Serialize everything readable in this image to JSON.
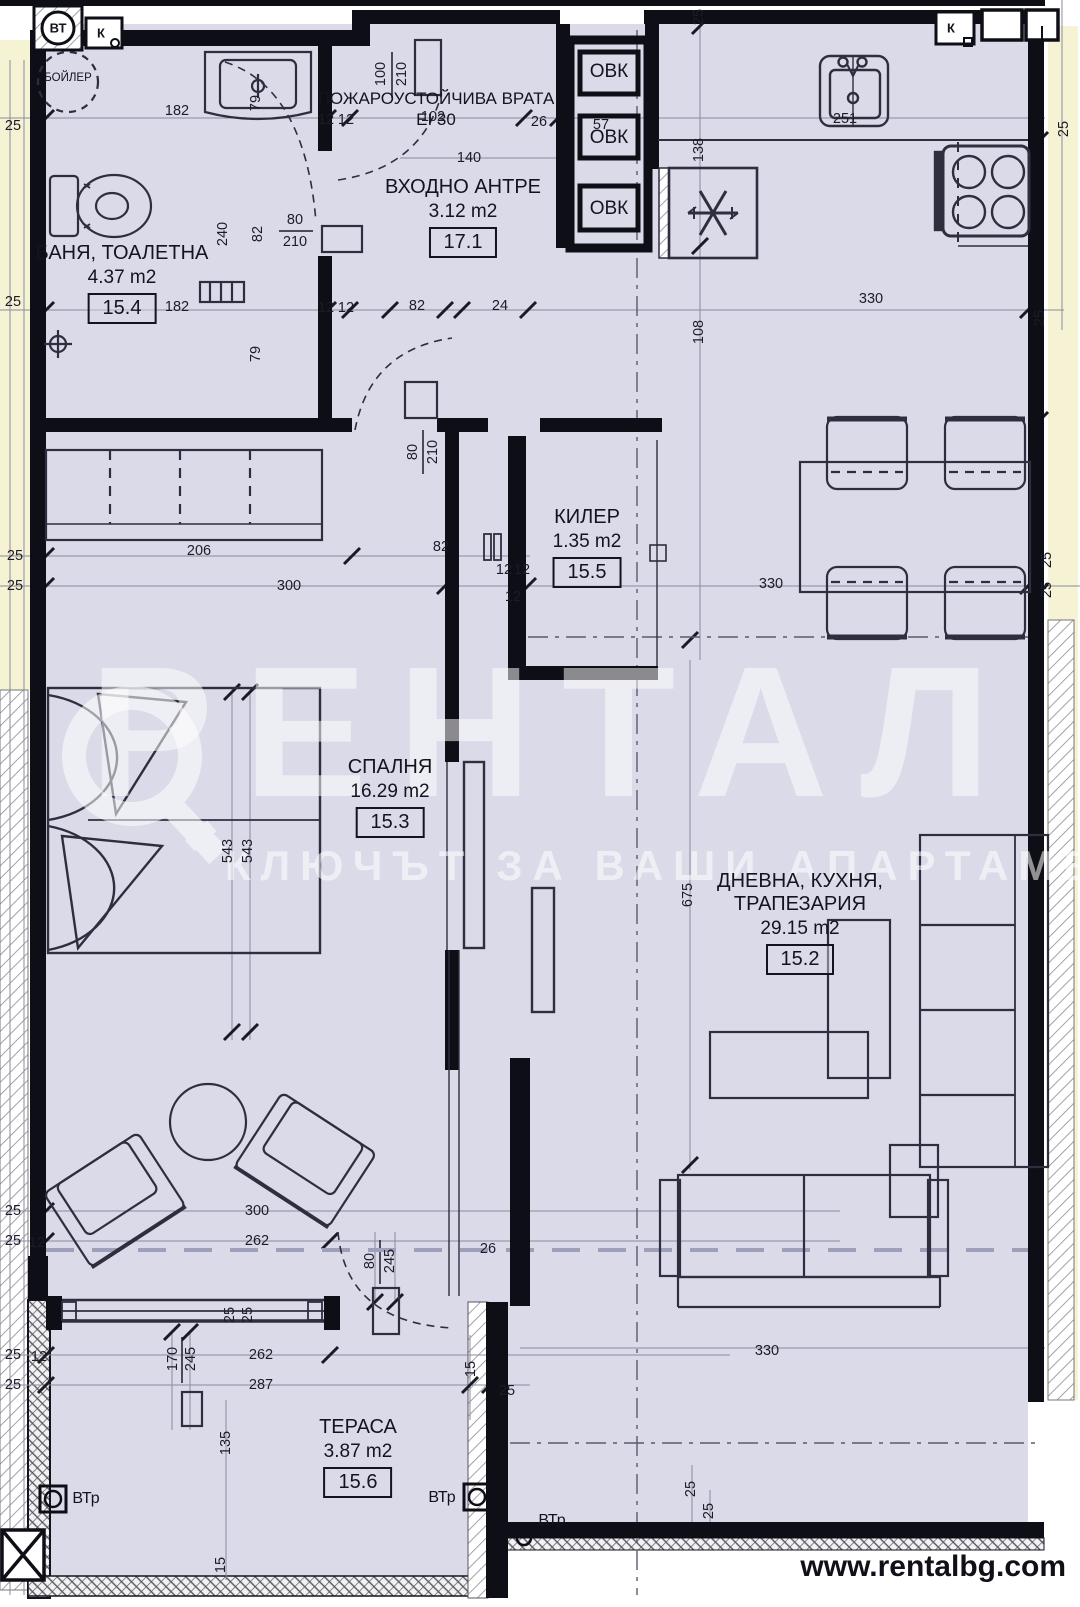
{
  "footer": {
    "website": "www.rentalbg.com"
  },
  "watermark": {
    "brand": "РЕНТАЛ",
    "slogan": "КЛЮЧЪТ ЗА ВАШИ АПАРТАМЕНТИ"
  },
  "rooms": [
    {
      "name": "БАНЯ, ТОАЛЕТНА",
      "area": "4.37 m2",
      "number": "15.4"
    },
    {
      "name": "ВХОДНО АНТРЕ",
      "area": "3.12 m2",
      "number": "17.1"
    },
    {
      "name": "КИЛЕР",
      "area": "1.35 m2",
      "number": "15.5"
    },
    {
      "name": "СПАЛНЯ",
      "area": "16.29 m2",
      "number": "15.3"
    },
    {
      "name": "ДНЕВНА, КУХНЯ, ТРАПЕЗАРИЯ",
      "area": "29.15 m2",
      "number": "15.2"
    },
    {
      "name": "ТЕРАСА",
      "area": "3.87 m2",
      "number": "15.6"
    }
  ],
  "labels": {
    "fire_door_line1": "ПОЖАРОУСТОЙЧИВА ВРАТА",
    "fire_door_line2": "EI 30",
    "boiler": "БОЙЛЕР",
    "shaft": "ОВК",
    "vt": "ВТ",
    "k": "К",
    "vtr": "ВТр"
  },
  "dimensions": [
    [
      "25",
      13,
      126,
      0
    ],
    [
      "182",
      177,
      111,
      0
    ],
    [
      "12",
      326,
      120,
      0
    ],
    [
      "12",
      346,
      120,
      0
    ],
    [
      "102",
      433,
      117,
      0
    ],
    [
      "140",
      469,
      158,
      0
    ],
    [
      "26",
      539,
      122,
      0
    ],
    [
      "57",
      601,
      125,
      0
    ],
    [
      "251",
      845,
      119,
      0
    ],
    [
      "100",
      381,
      74,
      -90
    ],
    [
      "210",
      402,
      74,
      -90
    ],
    [
      "25",
      699,
      17,
      -90
    ],
    [
      "25",
      1064,
      129,
      -90
    ],
    [
      "79",
      256,
      103,
      -90
    ],
    [
      "138",
      699,
      150,
      -90
    ],
    [
      "25",
      13,
      302,
      0
    ],
    [
      "182",
      177,
      307,
      0
    ],
    [
      "12",
      326,
      308,
      0
    ],
    [
      "12",
      346,
      308,
      0
    ],
    [
      "82",
      417,
      306,
      0
    ],
    [
      "24",
      500,
      306,
      0
    ],
    [
      "330",
      871,
      299,
      0
    ],
    [
      "80",
      295,
      220,
      0
    ],
    [
      "210",
      295,
      242,
      0
    ],
    [
      "240",
      223,
      234,
      -90
    ],
    [
      "82",
      258,
      234,
      -90
    ],
    [
      "79",
      256,
      354,
      -90
    ],
    [
      "108",
      699,
      332,
      -90
    ],
    [
      "25",
      1040,
      318,
      -90
    ],
    [
      "25",
      15,
      556,
      0
    ],
    [
      "25",
      15,
      586,
      0
    ],
    [
      "206",
      199,
      551,
      0
    ],
    [
      "82",
      441,
      547,
      0
    ],
    [
      "12",
      504,
      570,
      0
    ],
    [
      "12",
      522,
      570,
      0
    ],
    [
      "12",
      513,
      597,
      0
    ],
    [
      "300",
      289,
      586,
      0
    ],
    [
      "330",
      771,
      584,
      0
    ],
    [
      "80",
      413,
      452,
      -90
    ],
    [
      "210",
      433,
      452,
      -90
    ],
    [
      "25",
      1047,
      560,
      -90
    ],
    [
      "25",
      1047,
      590,
      -90
    ],
    [
      "543",
      228,
      851,
      -90
    ],
    [
      "543",
      248,
      851,
      -90
    ],
    [
      "675",
      688,
      895,
      -90
    ],
    [
      "300",
      257,
      1211,
      0
    ],
    [
      "262",
      257,
      1241,
      0
    ],
    [
      "25",
      13,
      1211,
      0
    ],
    [
      "25",
      13,
      1241,
      0
    ],
    [
      "12",
      37,
      1243,
      0
    ],
    [
      "26",
      488,
      1249,
      0
    ],
    [
      "25",
      230,
      1315,
      -90
    ],
    [
      "25",
      248,
      1315,
      -90
    ],
    [
      "80",
      370,
      1261,
      -90
    ],
    [
      "245",
      390,
      1261,
      -90
    ],
    [
      "170",
      173,
      1359,
      -90
    ],
    [
      "245",
      191,
      1359,
      -90
    ],
    [
      "262",
      261,
      1355,
      0
    ],
    [
      "287",
      261,
      1385,
      0
    ],
    [
      "25",
      13,
      1355,
      0
    ],
    [
      "25",
      13,
      1385,
      0
    ],
    [
      "12",
      39,
      1357,
      0
    ],
    [
      "135",
      226,
      1443,
      -90
    ],
    [
      "15",
      471,
      1369,
      -90
    ],
    [
      "25",
      507,
      1391,
      0
    ],
    [
      "330",
      767,
      1351,
      0
    ],
    [
      "25",
      691,
      1489,
      -90
    ],
    [
      "25",
      709,
      1511,
      -90
    ],
    [
      "15",
      221,
      1565,
      -90
    ]
  ],
  "colors": {
    "interior": "#dadae9",
    "exterior_band": "#f6f2d4",
    "wall": "#0e0e16",
    "furniture_line": "#2e2e3e",
    "dim_line": "#8b8ba2",
    "watermark": "rgba(255,255,255,0.55)"
  }
}
